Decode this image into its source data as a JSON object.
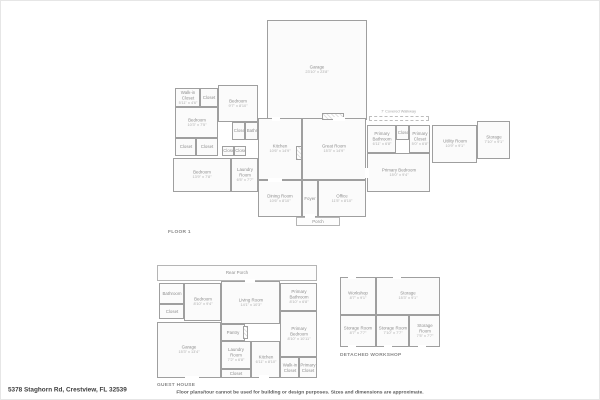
{
  "page": {
    "address": "5378 Staghorn Rd, Crestview, FL 32539",
    "disclaimer": "Floor plans/tour cannot be used for building or design purposes. Sizes and dimensions are approximate."
  },
  "floor1": {
    "title": "FLOOR 1",
    "walkway_note": "7' Covered Walkway",
    "rooms": {
      "garage": {
        "name": "Garage",
        "dims": "23'10\" x 23'8\""
      },
      "wic": {
        "name": "Walk-in Closet",
        "dims": "5'11\" x 4'6\""
      },
      "closet1": {
        "name": "Closet"
      },
      "bedroom2": {
        "name": "Bedroom",
        "dims": "9'7\" x 8'10\""
      },
      "bedroom3": {
        "name": "Bedroom",
        "dims": "10'3\" x 7'5\""
      },
      "closet2": {
        "name": "Closet"
      },
      "bathroom": {
        "name": "Bathroom"
      },
      "closet3": {
        "name": "Closet"
      },
      "closet4": {
        "name": "Closet"
      },
      "closet5": {
        "name": "Closet"
      },
      "closet6": {
        "name": "Closet"
      },
      "bedroom4": {
        "name": "Bedroom",
        "dims": "13'9\" x 7'8\""
      },
      "laundry": {
        "name": "Laundry Room",
        "dims": "6'5\" x 7'7\""
      },
      "kitchen": {
        "name": "Kitchen",
        "dims": "10'6\" x 14'9\""
      },
      "great_room": {
        "name": "Great Room",
        "dims": "15'3\" x 14'9\""
      },
      "dining": {
        "name": "Dining Room",
        "dims": "10'6\" x 8'10\""
      },
      "foyer": {
        "name": "Foyer"
      },
      "office": {
        "name": "Office",
        "dims": "11'5\" x 8'10\""
      },
      "porch": {
        "name": "Porch"
      },
      "primary_bathroom": {
        "name": "Primary Bathroom",
        "dims": "6'11\" x 6'8\""
      },
      "closet7": {
        "name": "Closet"
      },
      "primary_closet": {
        "name": "Primary Closet",
        "dims": "5'0\" x 6'8\""
      },
      "primary_bedroom": {
        "name": "Primary Bedroom",
        "dims": "15'0\" x 9'4\""
      },
      "utility": {
        "name": "Utility Room",
        "dims": "10'9\" x 9'1\""
      },
      "storage": {
        "name": "Storage",
        "dims": "7'10\" x 9'1\""
      }
    }
  },
  "guest_house": {
    "title": "GUEST HOUSE",
    "rooms": {
      "rear_porch": {
        "name": "Rear Porch",
        "dims": "38'1\" x 3'10\""
      },
      "bathroom": {
        "name": "Bathroom",
        "dims": "5'11\" x 5'0\""
      },
      "closet": {
        "name": "Closet"
      },
      "bedroom": {
        "name": "Bedroom",
        "dims": "8'10\" x 9'4\""
      },
      "living_room": {
        "name": "Living Room",
        "dims": "14'1\" x 10'3\""
      },
      "primary_bathroom": {
        "name": "Primary Bathroom",
        "dims": "8'10\" x 6'8\""
      },
      "primary_bedroom": {
        "name": "Primary Bedroom",
        "dims": "8'10\" x 10'11\""
      },
      "pantry": {
        "name": "Pantry",
        "dims": "5'8\" x 4'0\""
      },
      "garage": {
        "name": "Garage",
        "dims": "15'3\" x 13'4\""
      },
      "laundry": {
        "name": "Laundry Room",
        "dims": "7'2\" x 6'8\""
      },
      "closet2": {
        "name": "Closet"
      },
      "kitchen": {
        "name": "Kitchen",
        "dims": "6'11\" x 8'10\""
      },
      "wic": {
        "name": "Walk-in Closet"
      },
      "primary_closet": {
        "name": "Primary Closet"
      }
    }
  },
  "workshop": {
    "title": "DETACHED WORKSHOP",
    "rooms": {
      "workshop": {
        "name": "Workshop",
        "dims": "8'7\" x 9'1\""
      },
      "storage": {
        "name": "Storage",
        "dims": "15'3\" x 9'1\""
      },
      "storage_room1": {
        "name": "Storage Room",
        "dims": "8'7\" x 7'7\""
      },
      "storage_room2": {
        "name": "Storage Room",
        "dims": "7'10\" x 7'7\""
      },
      "storage_room3": {
        "name": "Storage Room",
        "dims": "7'5\" x 7'7\""
      }
    }
  }
}
